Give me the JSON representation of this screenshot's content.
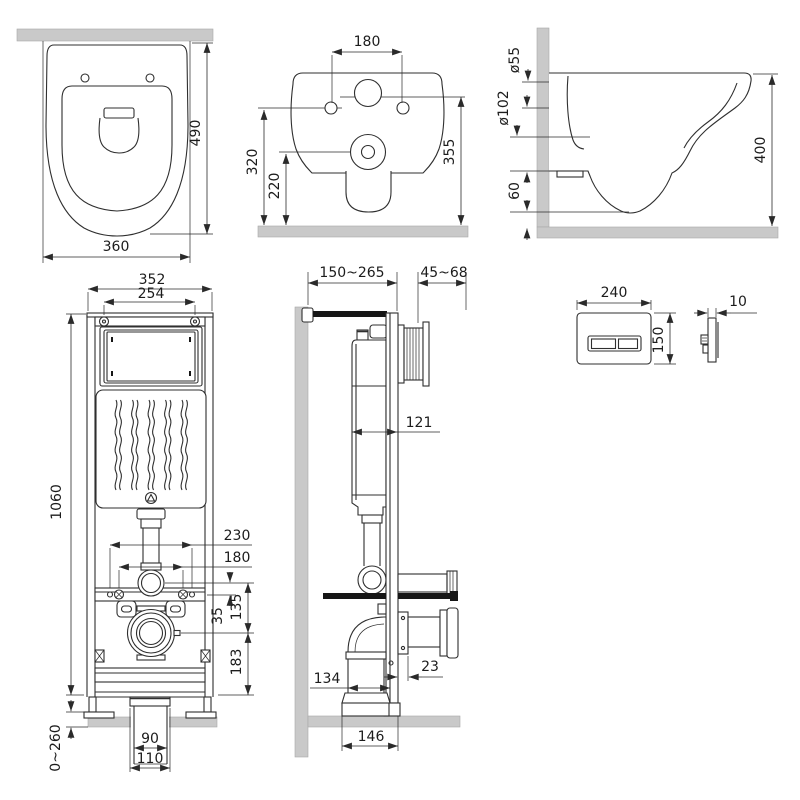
{
  "title": "Wall-hung toilet and installation frame dimensional drawing",
  "colors": {
    "background": "#ffffff",
    "line": "#2f2f2f",
    "dimension": "#2a2a2a",
    "wall_fill": "#c9c9c9",
    "hardware_black": "#161616"
  },
  "views": {
    "toilet_top": {
      "name": "toilet-top-view",
      "dims": {
        "depth": "490",
        "width": "360"
      }
    },
    "toilet_rear": {
      "name": "toilet-rear-view",
      "dims": {
        "bolt_spacing": "180",
        "bolt_height": "320",
        "outlet_height": "220",
        "inlet_height": "355"
      }
    },
    "toilet_side": {
      "name": "toilet-side-view",
      "dims": {
        "inlet_dia": "ø55",
        "outlet_dia": "ø102",
        "bottom_gap": "60",
        "height": "400"
      }
    },
    "frame_front": {
      "name": "installation-frame-front-view",
      "dims": {
        "width": "352",
        "top_bolt_spacing": "254",
        "height": "1060",
        "anchor_spacing": "230",
        "stud_spacing": "180",
        "flush_offset": "35",
        "flush_to_outlet": "135",
        "outlet_to_base": "183",
        "foot_adjust": "0~260",
        "outlet_pipe": "90",
        "outlet_socket": "110"
      }
    },
    "frame_side": {
      "name": "installation-frame-side-view",
      "dims": {
        "frame_depth": "150~265",
        "actuator_depth": "45~68",
        "cistern_depth": "121",
        "rail_to_outlet": "23",
        "elbow_depth": "134",
        "base_depth": "146"
      }
    },
    "flush_plate": {
      "name": "flush-plate-views",
      "dims": {
        "width": "240",
        "height": "150",
        "thickness": "10"
      }
    }
  }
}
